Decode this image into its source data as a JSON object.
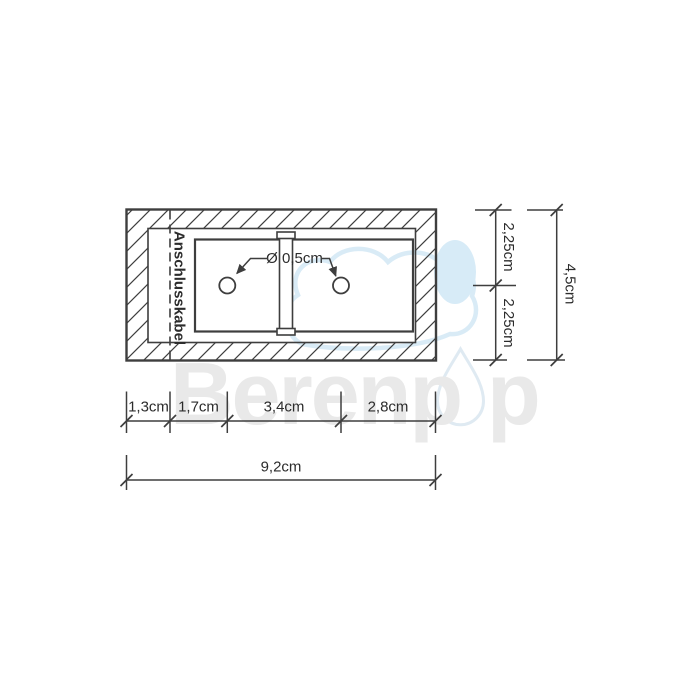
{
  "watermark": {
    "text_before_logo": "Berenp",
    "text_after_logo": "p",
    "logo": "water-drop-icon"
  },
  "labels": {
    "cable": "Anschlusskabel",
    "hole_diameter": "Ø 0,5cm"
  },
  "dimensions": {
    "right": {
      "upper": "2,25cm",
      "lower": "2,25cm",
      "total": "4,5cm"
    },
    "bottom": {
      "segments": [
        "1,3cm",
        "1,7cm",
        "3,4cm",
        "2,8cm"
      ],
      "total": "9,2cm"
    }
  },
  "colors": {
    "line": "#3e3e3e",
    "text": "#2c2c2c",
    "watermark_gray": "#e9e9e9",
    "watermark_blue": "#d9ebf6"
  }
}
